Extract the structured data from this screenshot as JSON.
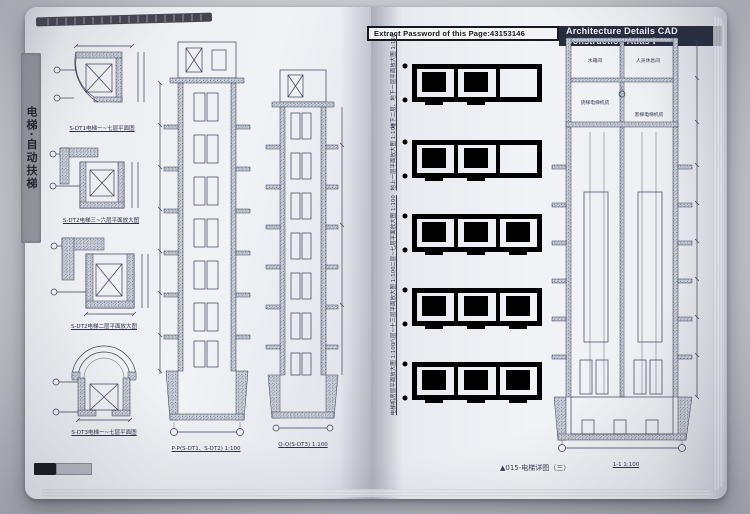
{
  "book": {
    "side_tab": "电梯·自动扶梯",
    "header": {
      "password": "Extract Password of this Page:43153146",
      "title": "Architecture Details CAD Construction Atlas Ⅰ"
    },
    "left_page": {
      "plans": [
        {
          "caption": "S-DT1电梯一~七层平面图"
        },
        {
          "caption": "S-DT2电梯三~六层平面放大图"
        },
        {
          "caption": "S-DT2电梯二层平面放大图"
        },
        {
          "caption": "S-DT3电梯一~七层平面图"
        }
      ],
      "sections": [
        {
          "caption": "P-P(S-DT1、S-DT2) 1:100"
        },
        {
          "caption": "Q-Q(S-DT3) 1:100"
        }
      ]
    },
    "right_page": {
      "strips": [
        {
          "caption": "地下二层、地下一层平面放大图 1:100"
        },
        {
          "caption": "地上一层平面放大图 1:100"
        },
        {
          "caption": "二层~七层平面放大图 1:100"
        },
        {
          "caption": "八层~十三层平面放大图 1:100"
        },
        {
          "caption": "电梯机房层平面放大图 1:100"
        }
      ],
      "section": {
        "rooms": [
          "水箱间",
          "人员休息间",
          "货梯电梯机房",
          "客梯电梯机房"
        ],
        "caption": "1-1 1:100"
      },
      "footer": "▲015-电梯详图（三）"
    }
  }
}
